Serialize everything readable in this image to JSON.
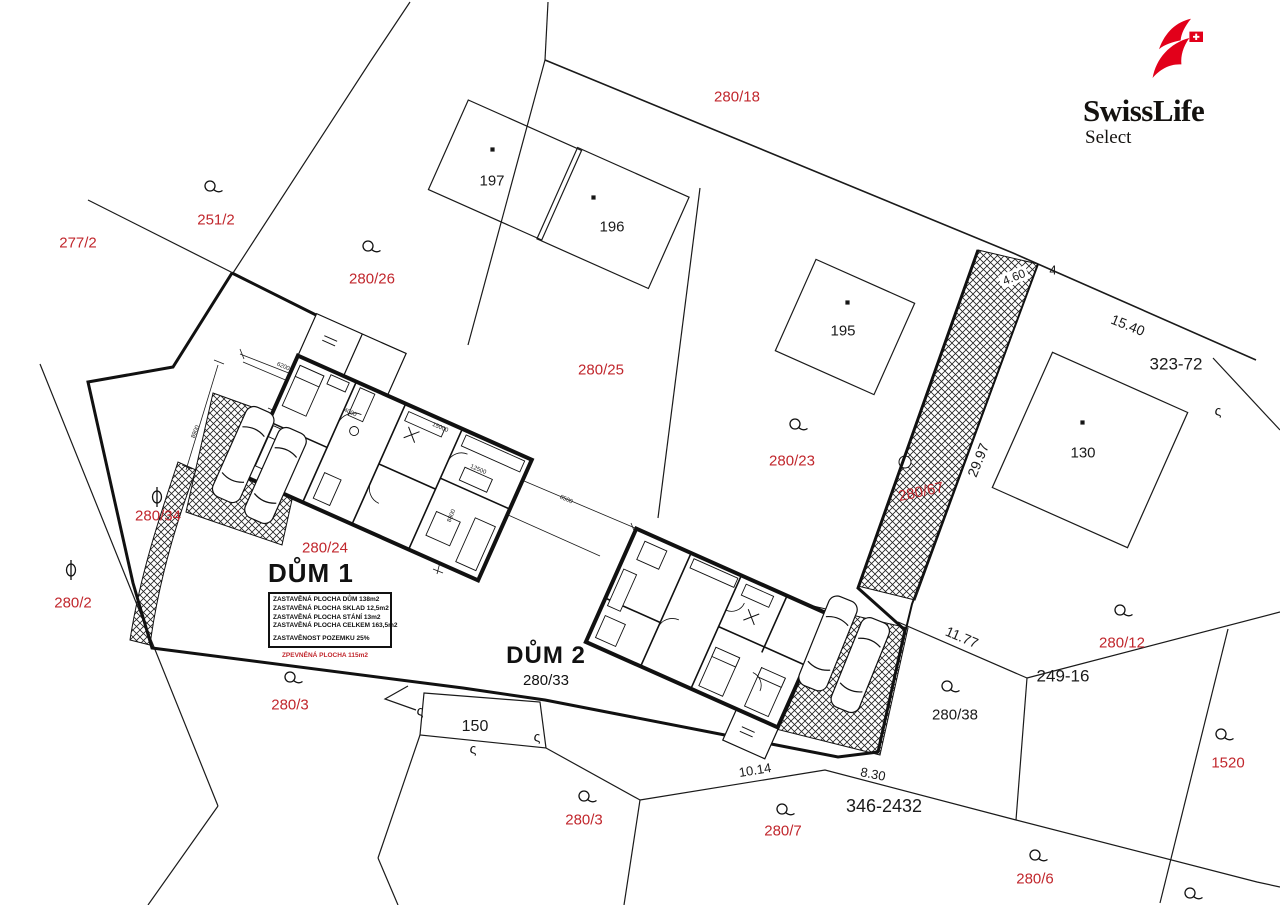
{
  "logo": {
    "brand": "SwissLife",
    "sub": "Select",
    "icon": "swisslife-flag-icon",
    "brand_red": "#e2001a"
  },
  "colors": {
    "parcel_red": "#c1272d",
    "line_black": "#1a1a1a",
    "background": "#ffffff"
  },
  "dum1": {
    "title": "DŮM 1",
    "rows": [
      "ZASTAVĚNÁ PLOCHA DŮM  138m2",
      "ZASTAVĚNÁ PLOCHA SKLAD  12,5m2",
      "ZASTAVĚNÁ PLOCHA STÁNÍ  13m2",
      "ZASTAVĚNÁ PLOCHA CELKEM  163,5m2",
      "ZASTAVĚNOST POZEMKU  25%"
    ],
    "note": "ZPEVNĚNÁ PLOCHA 115m2"
  },
  "dum2": {
    "title": "DŮM 2",
    "parcel": "280/33"
  },
  "map": {
    "parcel_labels_red": [
      {
        "text": "280/18",
        "x": 737,
        "y": 97
      },
      {
        "text": "277/2",
        "x": 78,
        "y": 243
      },
      {
        "text": "251/2",
        "x": 216,
        "y": 220
      },
      {
        "text": "280/26",
        "x": 372,
        "y": 279
      },
      {
        "text": "280/25",
        "x": 601,
        "y": 370
      },
      {
        "text": "280/23",
        "x": 792,
        "y": 461
      },
      {
        "text": "280/34",
        "x": 158,
        "y": 516
      },
      {
        "text": "280/2",
        "x": 73,
        "y": 603
      },
      {
        "text": "280/24",
        "x": 325,
        "y": 548
      },
      {
        "text": "280/3",
        "x": 290,
        "y": 705
      },
      {
        "text": "280/3",
        "x": 584,
        "y": 820
      },
      {
        "text": "280/7",
        "x": 783,
        "y": 831
      },
      {
        "text": "280/12",
        "x": 1122,
        "y": 643
      },
      {
        "text": "1520",
        "x": 1228,
        "y": 763
      },
      {
        "text": "280/6",
        "x": 1035,
        "y": 879
      },
      {
        "text": "280/67",
        "x": 921,
        "y": 492,
        "rot": -12
      }
    ],
    "ref_labels_black": [
      {
        "text": "197",
        "x": 492,
        "y": 181,
        "size": 15
      },
      {
        "text": "196",
        "x": 612,
        "y": 227,
        "size": 15
      },
      {
        "text": "195",
        "x": 843,
        "y": 331,
        "size": 15
      },
      {
        "text": "130",
        "x": 1083,
        "y": 453,
        "size": 15
      },
      {
        "text": "4",
        "x": 1053,
        "y": 270,
        "size": 13
      },
      {
        "text": "323-72",
        "x": 1176,
        "y": 364,
        "size": 17
      },
      {
        "text": "249-16",
        "x": 1063,
        "y": 676,
        "size": 17
      },
      {
        "text": "346-2432",
        "x": 884,
        "y": 806,
        "size": 18
      },
      {
        "text": "150",
        "x": 475,
        "y": 727,
        "size": 16
      },
      {
        "text": "280/38",
        "x": 955,
        "y": 715,
        "size": 15
      }
    ],
    "dimension_labels": [
      {
        "text": "15.40",
        "x": 1128,
        "y": 325,
        "rot": 22,
        "size": 14
      },
      {
        "text": "29.97",
        "x": 978,
        "y": 460,
        "rot": -68,
        "size": 14
      },
      {
        "text": "4.60",
        "x": 1014,
        "y": 277,
        "rot": -22,
        "size": 12,
        "boxed": true
      },
      {
        "text": "11.77",
        "x": 962,
        "y": 637,
        "rot": 23,
        "size": 14
      },
      {
        "text": "10.14",
        "x": 755,
        "y": 770,
        "rot": -9,
        "size": 13
      },
      {
        "text": "8.30",
        "x": 873,
        "y": 774,
        "rot": 11,
        "size": 13
      }
    ],
    "construction_dims": [
      {
        "text": "6200",
        "x": 283,
        "y": 367,
        "rot": 23
      },
      {
        "text": "15000",
        "x": 440,
        "y": 428,
        "rot": 23
      },
      {
        "text": "12500",
        "x": 478,
        "y": 470,
        "rot": 23
      },
      {
        "text": "8500",
        "x": 566,
        "y": 500,
        "rot": 23
      },
      {
        "text": "4000",
        "x": 350,
        "y": 413,
        "rot": 23
      },
      {
        "text": "8800",
        "x": 452,
        "y": 516,
        "rot": -68
      },
      {
        "text": "8900",
        "x": 196,
        "y": 432,
        "rot": -68
      }
    ],
    "symbols": {
      "s_glyph": "ς",
      "orchard": [
        {
          "x": 210,
          "y": 186
        },
        {
          "x": 368,
          "y": 246
        },
        {
          "x": 795,
          "y": 424
        },
        {
          "x": 947,
          "y": 686
        },
        {
          "x": 290,
          "y": 677
        },
        {
          "x": 584,
          "y": 796
        },
        {
          "x": 782,
          "y": 809
        },
        {
          "x": 1120,
          "y": 610
        },
        {
          "x": 1221,
          "y": 734
        },
        {
          "x": 1035,
          "y": 855
        },
        {
          "x": 1190,
          "y": 893
        }
      ],
      "meadow": [
        {
          "x": 157,
          "y": 497
        },
        {
          "x": 71,
          "y": 570
        }
      ],
      "boundary_marks": [
        {
          "x": 1218,
          "y": 412
        },
        {
          "x": 420,
          "y": 712
        },
        {
          "x": 473,
          "y": 750
        },
        {
          "x": 537,
          "y": 738
        }
      ]
    }
  }
}
